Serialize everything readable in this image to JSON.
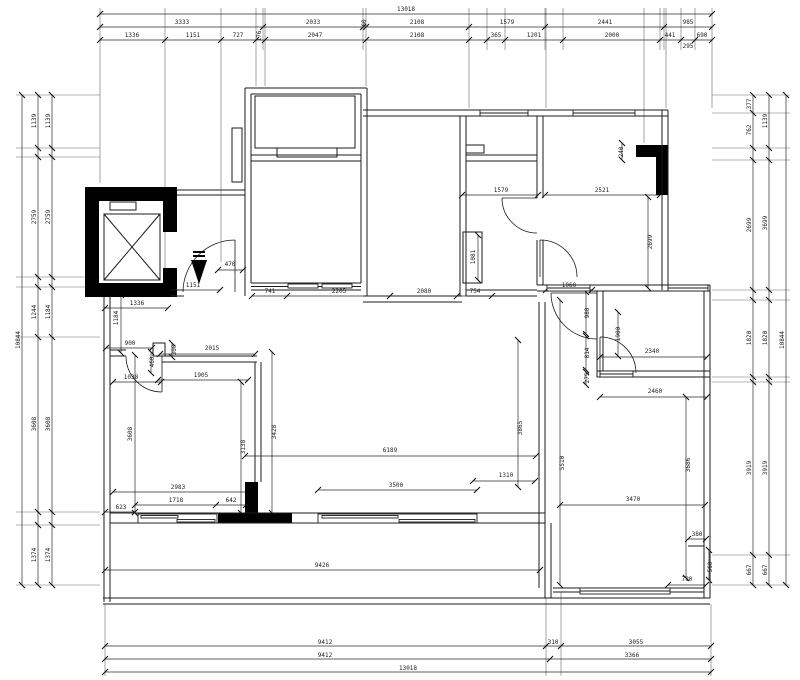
{
  "drawing": {
    "title": "Apartment floor plan (CAD dimension drawing)",
    "total_width_mm": "13018",
    "total_height_mm": "10844",
    "line_color": "#1b1b1b",
    "fill_color": "#000000",
    "background": "#ffffff",
    "icons": [
      "elevator-shaft-x-icon",
      "entry-direction-arrow-icon",
      "door-swing-arc",
      "window-sash"
    ]
  },
  "dimension_labels": [
    {
      "text": "13018",
      "x": 406,
      "y": 11,
      "rot": 0
    },
    {
      "text": "3333",
      "x": 182,
      "y": 24,
      "rot": 0
    },
    {
      "text": "2033",
      "x": 313,
      "y": 24,
      "rot": 0
    },
    {
      "text": "60",
      "x": 366,
      "y": 23,
      "rot": -90
    },
    {
      "text": "2108",
      "x": 417,
      "y": 24,
      "rot": 0
    },
    {
      "text": "1579",
      "x": 507,
      "y": 24,
      "rot": 0
    },
    {
      "text": "2441",
      "x": 605,
      "y": 24,
      "rot": 0
    },
    {
      "text": "985",
      "x": 688,
      "y": 24,
      "rot": 0
    },
    {
      "text": "1336",
      "x": 132,
      "y": 37,
      "rot": 0
    },
    {
      "text": "1151",
      "x": 193,
      "y": 37,
      "rot": 0
    },
    {
      "text": "727",
      "x": 238,
      "y": 37,
      "rot": 0
    },
    {
      "text": "176",
      "x": 261,
      "y": 36,
      "rot": -90
    },
    {
      "text": "2047",
      "x": 315,
      "y": 37,
      "rot": 0
    },
    {
      "text": "2108",
      "x": 417,
      "y": 37,
      "rot": 0
    },
    {
      "text": "365",
      "x": 496,
      "y": 37,
      "rot": 0
    },
    {
      "text": "1201",
      "x": 534,
      "y": 37,
      "rot": 0
    },
    {
      "text": "2000",
      "x": 612,
      "y": 37,
      "rot": 0
    },
    {
      "text": "441",
      "x": 670,
      "y": 37,
      "rot": 0
    },
    {
      "text": "295",
      "x": 688,
      "y": 48,
      "rot": 0
    },
    {
      "text": "690",
      "x": 702,
      "y": 37,
      "rot": 0
    },
    {
      "text": "9412",
      "x": 325,
      "y": 644,
      "rot": 0
    },
    {
      "text": "310",
      "x": 553,
      "y": 644,
      "rot": 0
    },
    {
      "text": "3055",
      "x": 636,
      "y": 644,
      "rot": 0
    },
    {
      "text": "9412",
      "x": 325,
      "y": 657,
      "rot": 0
    },
    {
      "text": "3366",
      "x": 632,
      "y": 657,
      "rot": 0
    },
    {
      "text": "13018",
      "x": 408,
      "y": 670,
      "rot": 0
    },
    {
      "text": "1139",
      "x": 36,
      "y": 121,
      "rot": -90
    },
    {
      "text": "2759",
      "x": 36,
      "y": 217,
      "rot": -90
    },
    {
      "text": "1244",
      "x": 36,
      "y": 312,
      "rot": -90
    },
    {
      "text": "3608",
      "x": 36,
      "y": 424,
      "rot": -90
    },
    {
      "text": "1374",
      "x": 36,
      "y": 555,
      "rot": -90
    },
    {
      "text": "1139",
      "x": 50,
      "y": 121,
      "rot": -90
    },
    {
      "text": "2759",
      "x": 50,
      "y": 217,
      "rot": -90
    },
    {
      "text": "1184",
      "x": 50,
      "y": 312,
      "rot": -90
    },
    {
      "text": "3608",
      "x": 50,
      "y": 424,
      "rot": -90
    },
    {
      "text": "1374",
      "x": 50,
      "y": 555,
      "rot": -90
    },
    {
      "text": "10844",
      "x": 20,
      "y": 340,
      "rot": -90
    },
    {
      "text": "377",
      "x": 751,
      "y": 104,
      "rot": -90
    },
    {
      "text": "762",
      "x": 751,
      "y": 130,
      "rot": -90
    },
    {
      "text": "2699",
      "x": 751,
      "y": 225,
      "rot": -90
    },
    {
      "text": "1820",
      "x": 751,
      "y": 338,
      "rot": -90
    },
    {
      "text": "3919",
      "x": 751,
      "y": 468,
      "rot": -90
    },
    {
      "text": "667",
      "x": 751,
      "y": 570,
      "rot": -90
    },
    {
      "text": "1139",
      "x": 767,
      "y": 121,
      "rot": -90
    },
    {
      "text": "3699",
      "x": 767,
      "y": 223,
      "rot": -90
    },
    {
      "text": "1820",
      "x": 767,
      "y": 338,
      "rot": -90
    },
    {
      "text": "3919",
      "x": 767,
      "y": 468,
      "rot": -90
    },
    {
      "text": "667",
      "x": 767,
      "y": 570,
      "rot": -90
    },
    {
      "text": "10844",
      "x": 784,
      "y": 340,
      "rot": -90
    },
    {
      "text": "470",
      "x": 230,
      "y": 266,
      "rot": 0
    },
    {
      "text": "1151",
      "x": 193,
      "y": 287,
      "rot": 0
    },
    {
      "text": "741",
      "x": 270,
      "y": 293,
      "rot": 0
    },
    {
      "text": "2205",
      "x": 339,
      "y": 293,
      "rot": 0
    },
    {
      "text": "2080",
      "x": 424,
      "y": 293,
      "rot": 0
    },
    {
      "text": "754",
      "x": 475,
      "y": 293,
      "rot": 0
    },
    {
      "text": "1060",
      "x": 569,
      "y": 287,
      "rot": 0
    },
    {
      "text": "1336",
      "x": 137,
      "y": 305,
      "rot": 0
    },
    {
      "text": "1184",
      "x": 118,
      "y": 318,
      "rot": -90
    },
    {
      "text": "623",
      "x": 121,
      "y": 509,
      "rot": 0
    },
    {
      "text": "1579",
      "x": 501,
      "y": 192,
      "rot": 0
    },
    {
      "text": "2521",
      "x": 602,
      "y": 192,
      "rot": 0
    },
    {
      "text": "240",
      "x": 623,
      "y": 152,
      "rot": -90
    },
    {
      "text": "2699",
      "x": 652,
      "y": 242,
      "rot": -90
    },
    {
      "text": "1081",
      "x": 475,
      "y": 257,
      "rot": -90
    },
    {
      "text": "980",
      "x": 589,
      "y": 313,
      "rot": -90
    },
    {
      "text": "1900",
      "x": 620,
      "y": 334,
      "rot": -90
    },
    {
      "text": "814",
      "x": 589,
      "y": 353,
      "rot": -90
    },
    {
      "text": "275",
      "x": 589,
      "y": 378,
      "rot": -90
    },
    {
      "text": "2340",
      "x": 652,
      "y": 353,
      "rot": 0
    },
    {
      "text": "2460",
      "x": 655,
      "y": 393,
      "rot": 0
    },
    {
      "text": "900",
      "x": 130,
      "y": 345,
      "rot": 0
    },
    {
      "text": "300",
      "x": 176,
      "y": 350,
      "rot": -90
    },
    {
      "text": "2015",
      "x": 212,
      "y": 350,
      "rot": 0
    },
    {
      "text": "460",
      "x": 154,
      "y": 362,
      "rot": -90
    },
    {
      "text": "1030",
      "x": 131,
      "y": 379,
      "rot": 0
    },
    {
      "text": "1905",
      "x": 201,
      "y": 377,
      "rot": 0
    },
    {
      "text": "3608",
      "x": 132,
      "y": 434,
      "rot": -90
    },
    {
      "text": "3138",
      "x": 245,
      "y": 447,
      "rot": -90
    },
    {
      "text": "3428",
      "x": 276,
      "y": 432,
      "rot": -90
    },
    {
      "text": "6189",
      "x": 390,
      "y": 452,
      "rot": 0
    },
    {
      "text": "3865",
      "x": 522,
      "y": 428,
      "rot": -90
    },
    {
      "text": "1310",
      "x": 506,
      "y": 477,
      "rot": 0
    },
    {
      "text": "5510",
      "x": 564,
      "y": 463,
      "rot": -90
    },
    {
      "text": "3686",
      "x": 690,
      "y": 465,
      "rot": -90
    },
    {
      "text": "2983",
      "x": 178,
      "y": 489,
      "rot": 0
    },
    {
      "text": "1718",
      "x": 176,
      "y": 502,
      "rot": 0
    },
    {
      "text": "642",
      "x": 231,
      "y": 502,
      "rot": 0
    },
    {
      "text": "3500",
      "x": 396,
      "y": 487,
      "rot": 0
    },
    {
      "text": "3470",
      "x": 633,
      "y": 501,
      "rot": 0
    },
    {
      "text": "380",
      "x": 697,
      "y": 536,
      "rot": 0
    },
    {
      "text": "560",
      "x": 712,
      "y": 567,
      "rot": -90
    },
    {
      "text": "780",
      "x": 687,
      "y": 581,
      "rot": 0
    },
    {
      "text": "9426",
      "x": 322,
      "y": 567,
      "rot": 0
    }
  ]
}
